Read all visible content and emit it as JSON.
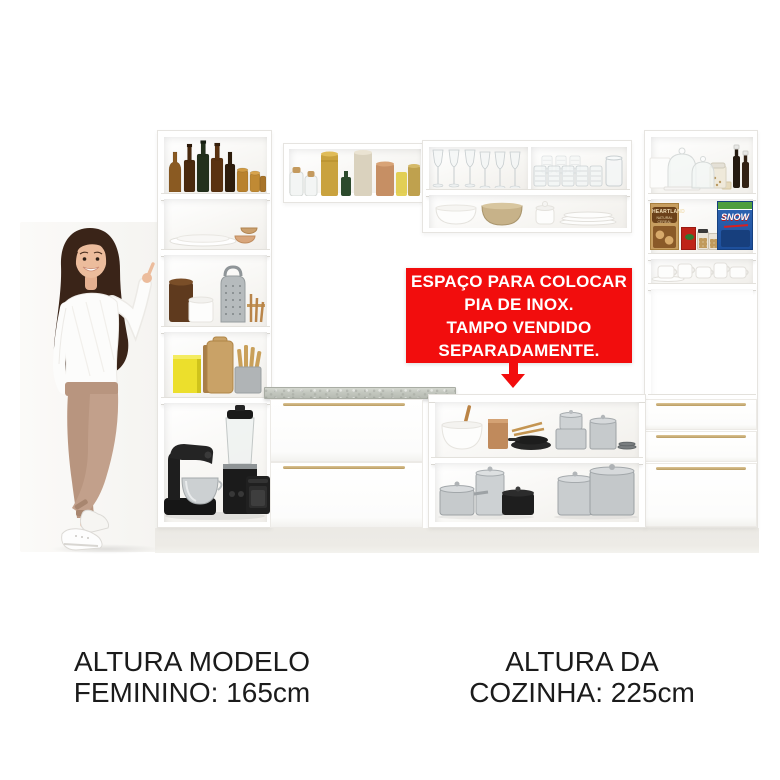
{
  "image": {
    "width": 780,
    "height": 780,
    "background": "#ffffff"
  },
  "overlay_banner": {
    "bg_color": "#f20d0d",
    "text_color": "#ffffff",
    "lines": [
      "ESPAÇO PARA COLOCAR",
      "PIA DE INOX.",
      "TAMPO VENDIDO",
      "SEPARADAMENTE."
    ],
    "arrow_icon": "arrow-down-icon"
  },
  "captions": {
    "text_color": "#1b1b1b",
    "model_height": {
      "line1": "ALTURA MODELO",
      "line2": "FEMININO: 165cm"
    },
    "kitchen_height": {
      "line1": "ALTURA DA",
      "line2": "COZINHA: 225cm"
    }
  },
  "shelf_products": {
    "cereal_box_heartland": {
      "brand": "HEARTLAND",
      "subtitle": "NATURAL CEREAL",
      "box_color": "#c79e60"
    },
    "cereal_box_snow": {
      "brand": "SNOW",
      "box_color": "#1d5fb0"
    }
  },
  "palette": {
    "cabinet_white": "#ffffff",
    "cabinet_edge": "#e6e4e0",
    "countertop_gray": "#c3c7bf",
    "handle_gold": "#c9ab72",
    "plinth": "#edebe6",
    "photo_backdrop": "#f6f5f2",
    "trousers_tan": "#c2a08b",
    "hair_brown": "#3a2418"
  }
}
